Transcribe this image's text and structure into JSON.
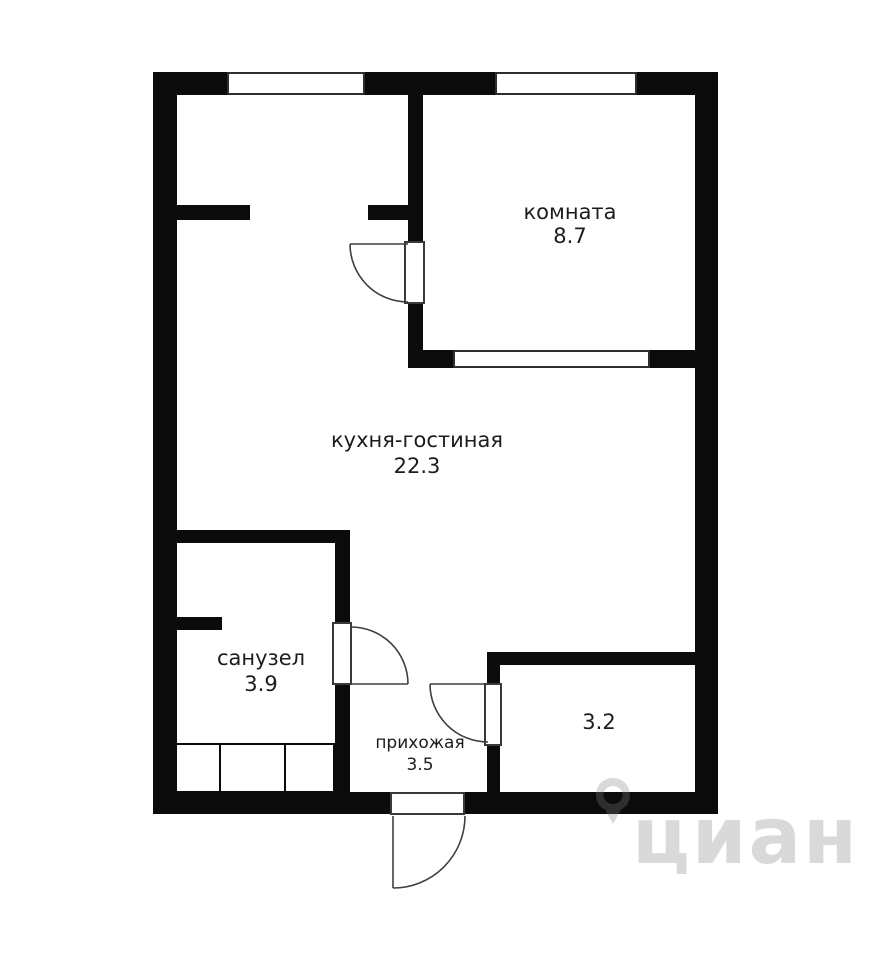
{
  "rooms": {
    "bedroom": {
      "name": "комната",
      "area": "8.7"
    },
    "kitchen_living": {
      "name": "кухня-гостиная",
      "area": "22.3"
    },
    "bathroom": {
      "name": "санузел",
      "area": "3.9"
    },
    "hallway": {
      "name": "прихожая",
      "area": "3.5"
    },
    "storage": {
      "area": "3.2"
    }
  },
  "watermark": {
    "brand": "циан"
  },
  "colors": {
    "wall": "#0b0b0b",
    "label_text": "#1c1c1c",
    "door_swing": "#3f3f3f",
    "watermark": "rgba(130,130,130,0.30)"
  }
}
